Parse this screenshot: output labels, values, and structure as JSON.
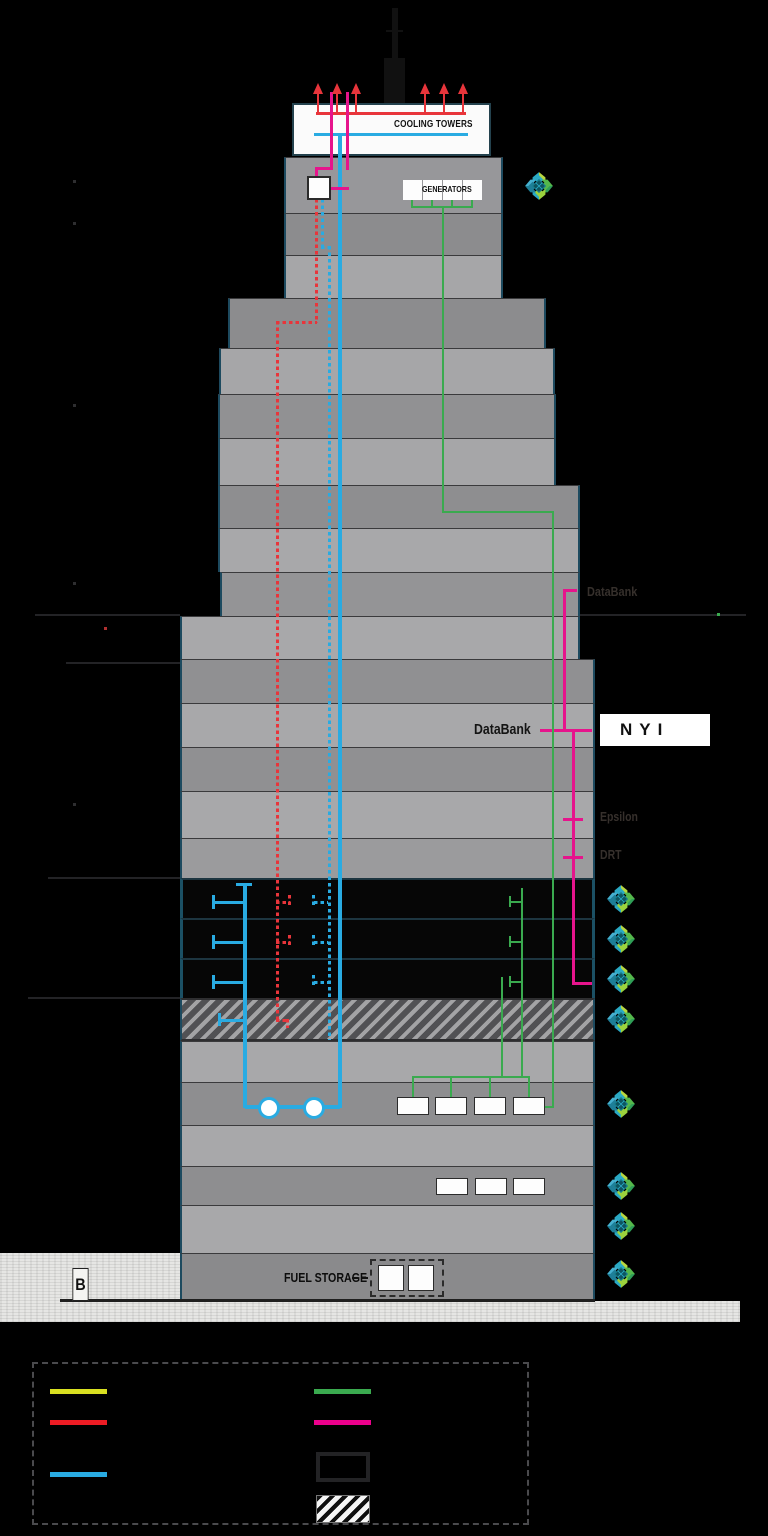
{
  "building": {
    "cooling_towers_label": "COOLING TOWERS",
    "generators_label": "GENERATORS",
    "fuel_storage_label": "FUEL STORAGE",
    "basement_marker": "B"
  },
  "tenants": {
    "databank": "DataBank",
    "nyi": "NYI",
    "dim": [
      {
        "text": "DataBank"
      },
      {
        "text": "Epsilon"
      },
      {
        "text": "DRT"
      }
    ]
  },
  "colors": {
    "cyan": "#29abe2",
    "red": "#e8353b",
    "green": "#3aaa4f",
    "magenta": "#e6148c",
    "legend_yellow": "#d9e021",
    "legend_red": "#ed1c24",
    "legend_green": "#3aaa4f",
    "legend_magenta": "#ec008c",
    "legend_blue": "#29abe2"
  },
  "legend": {
    "columns": [
      [
        {
          "swatch": "line",
          "color": "#d9e021",
          "label": ""
        },
        {
          "swatch": "line",
          "color": "#ed1c24",
          "label": ""
        },
        {
          "swatch": "line",
          "color": "#29abe2",
          "label": ""
        }
      ],
      [
        {
          "swatch": "line",
          "color": "#3aaa4f",
          "label": ""
        },
        {
          "swatch": "line",
          "color": "#ec008c",
          "label": ""
        },
        {
          "swatch": "box-outline",
          "color": "#232325",
          "label": ""
        },
        {
          "swatch": "box-hatched",
          "color": "#f5f5f5",
          "label": ""
        }
      ]
    ]
  },
  "logo_marker_count": 9
}
